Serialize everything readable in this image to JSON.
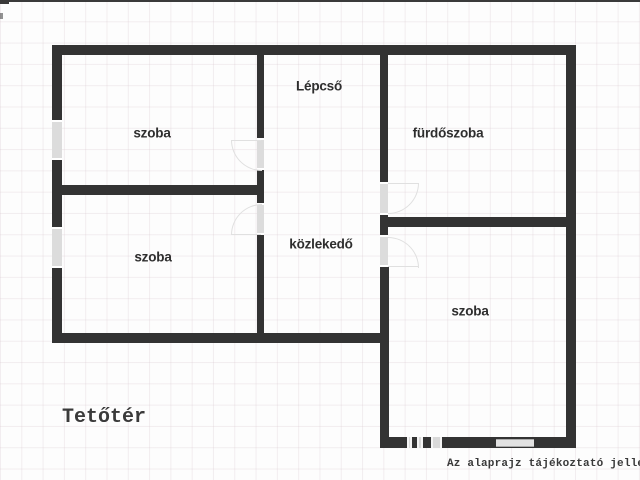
{
  "plan_title": "Tetőtér",
  "rooms": {
    "staircase": "Lépcső",
    "room_top_left": "szoba",
    "bathroom": "fürdőszoba",
    "room_bottom_left": "szoba",
    "hallway": "közlekedő",
    "room_right": "szoba"
  },
  "captions": {
    "floor_name": "Tetőtér",
    "disclaimer": "Az alaprajz tájékoztató jellegű"
  },
  "colors": {
    "wall": "#333333",
    "opening": "#dcdcdc",
    "text": "#2e2e2e",
    "background": "#fdfdfd"
  }
}
